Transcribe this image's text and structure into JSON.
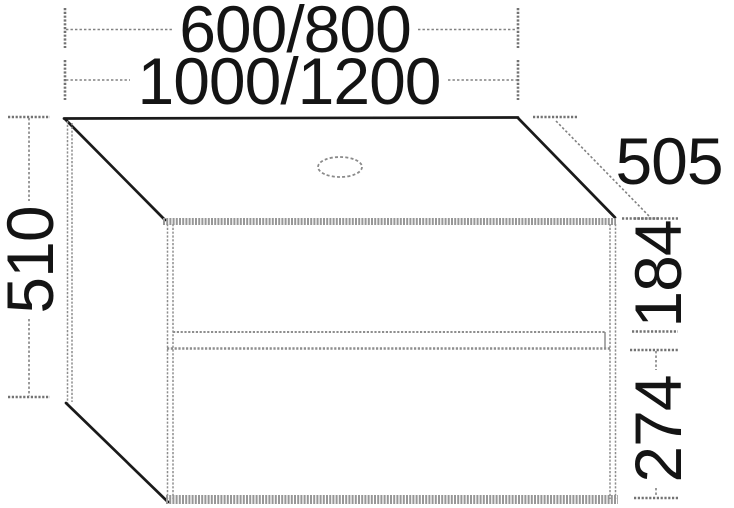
{
  "dimensions": {
    "width_options_top": "600/800",
    "width_options_bottom": "1000/1200",
    "height": "510",
    "depth": "505",
    "top_drawer_front": "184",
    "bottom_drawer_front": "274"
  },
  "colors": {
    "outline": "#1a1a1a",
    "secondary_line": "#8e8e8e",
    "dimension_line": "#818181",
    "text": "#141414",
    "background": "#ffffff"
  }
}
